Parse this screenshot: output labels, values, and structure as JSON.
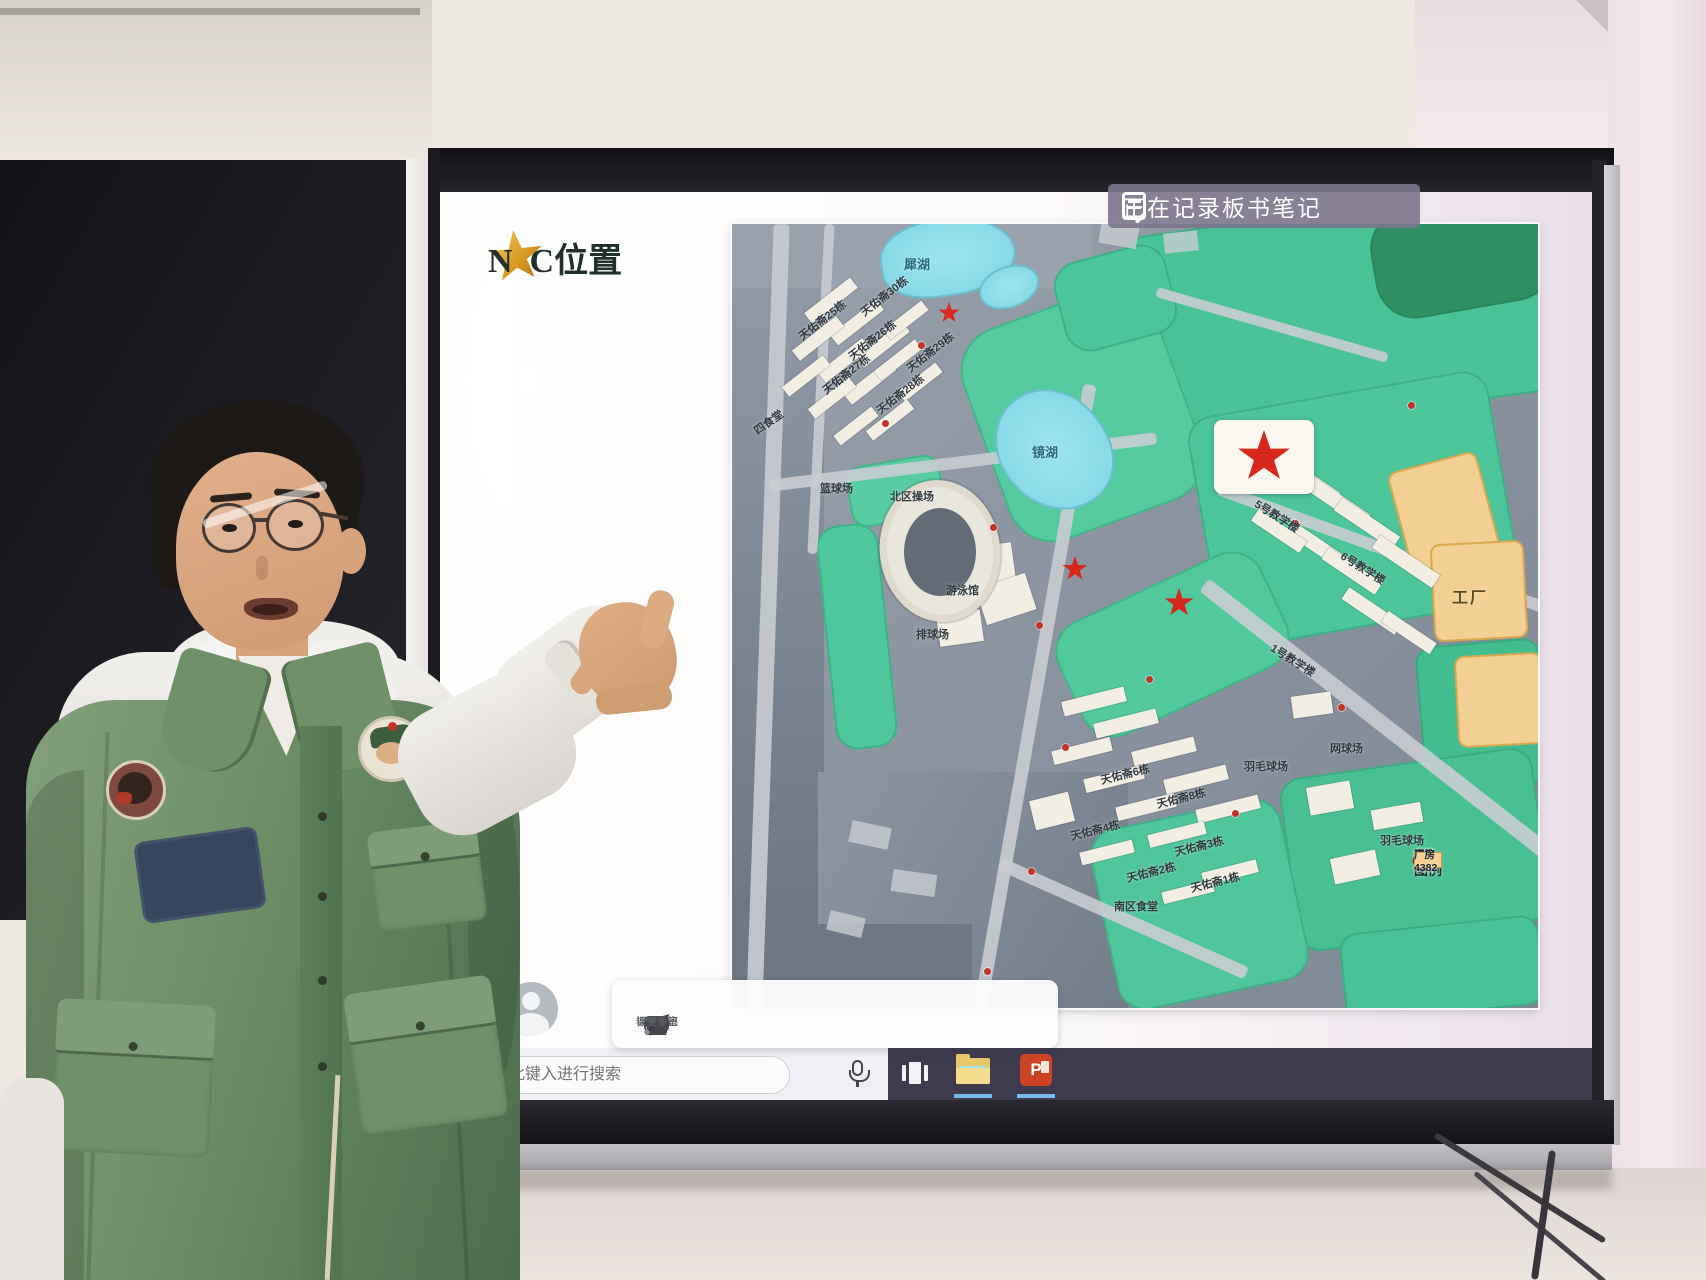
{
  "screen": {
    "recording_banner": {
      "icon": "note-pencil-icon",
      "text": "正在记录板书笔记"
    },
    "slide": {
      "title": "N  C位置"
    },
    "toolbar": {
      "avatar_icon": "person-icon",
      "items": [
        {
          "icon": "annotate-pen-icon",
          "label": "标注"
        },
        {
          "icon": "eraser-icon",
          "label": "板擦"
        },
        {
          "icon": "spotlight-icon",
          "label": "聚光"
        },
        {
          "icon": "class-activity-icon",
          "label": "课堂考察"
        },
        {
          "icon": "qa-icon",
          "label": "课堂问答",
          "badge": "QA"
        },
        {
          "icon": "notes-pencil-icon",
          "label": "板书笔记"
        },
        {
          "icon": "more-icon",
          "label": "更多"
        }
      ]
    },
    "taskbar": {
      "search_placeholder": "在此键入进行搜索",
      "powerpoint_letter": "P",
      "icons": [
        "search-icon",
        "microphone-icon",
        "task-view-icon",
        "file-explorer-icon",
        "powerpoint-icon"
      ]
    }
  },
  "map": {
    "labels": [
      {
        "t": "犀湖",
        "x": 172,
        "y": 30,
        "c": "lake-t"
      },
      {
        "t": "镜湖",
        "x": 300,
        "y": 218,
        "c": "lake-t"
      },
      {
        "t": "篮球场",
        "x": 88,
        "y": 256
      },
      {
        "t": "北区操场",
        "x": 158,
        "y": 264
      },
      {
        "t": "游泳馆",
        "x": 214,
        "y": 358
      },
      {
        "t": "排球场",
        "x": 184,
        "y": 402
      },
      {
        "t": "网球场",
        "x": 598,
        "y": 516
      },
      {
        "t": "羽毛球场",
        "x": 512,
        "y": 534
      },
      {
        "t": "羽毛球场",
        "x": 648,
        "y": 608
      },
      {
        "t": "南区食堂",
        "x": 382,
        "y": 674
      },
      {
        "t": "四食堂",
        "x": 20,
        "y": 190,
        "r": -35
      },
      {
        "t": "工厂",
        "x": 720,
        "y": 360,
        "c": "factory"
      },
      {
        "t": "5号教学楼",
        "x": 520,
        "y": 284,
        "r": 32
      },
      {
        "t": "6号教学楼",
        "x": 606,
        "y": 336,
        "r": 32
      },
      {
        "t": "1号教学楼",
        "x": 536,
        "y": 428,
        "r": 32
      },
      {
        "t": "天佑斋25栋",
        "x": 62,
        "y": 88,
        "r": -38
      },
      {
        "t": "天佑斋26栋",
        "x": 112,
        "y": 108,
        "r": -38
      },
      {
        "t": "天佑斋27栋",
        "x": 86,
        "y": 142,
        "r": -38
      },
      {
        "t": "天佑斋28栋",
        "x": 140,
        "y": 162,
        "r": -38
      },
      {
        "t": "天佑斋29栋",
        "x": 170,
        "y": 120,
        "r": -38
      },
      {
        "t": "天佑斋30栋",
        "x": 124,
        "y": 64,
        "r": -38
      },
      {
        "t": "天佑斋6栋",
        "x": 368,
        "y": 542,
        "r": -14
      },
      {
        "t": "天佑斋8栋",
        "x": 424,
        "y": 566,
        "r": -14
      },
      {
        "t": "天佑斋4栋",
        "x": 338,
        "y": 598,
        "r": -14
      },
      {
        "t": "天佑斋3栋",
        "x": 442,
        "y": 614,
        "r": -14
      },
      {
        "t": "天佑斋2栋",
        "x": 394,
        "y": 640,
        "r": -14
      },
      {
        "t": "天佑斋1栋",
        "x": 458,
        "y": 650,
        "r": -14
      }
    ],
    "stars": [
      {
        "x": 206,
        "y": 78,
        "s": 22
      },
      {
        "x": 505,
        "y": 206,
        "s": 54,
        "card": {
          "x": 482,
          "y": 196,
          "w": 100,
          "h": 74
        }
      },
      {
        "x": 330,
        "y": 332,
        "s": 26
      },
      {
        "x": 432,
        "y": 364,
        "s": 30
      }
    ],
    "legend": {
      "title": "图例",
      "items": [
        {
          "symbol": "camera-dot",
          "label": "监控4382"
        },
        {
          "symbol": "thin-line",
          "label": "小路4382"
        },
        {
          "symbol": "double-line",
          "label": "道路4382"
        },
        {
          "symbol": "building-swatch",
          "label": "建筑4382"
        },
        {
          "symbol": "factory-swatch",
          "label": "厂房4382"
        }
      ]
    }
  },
  "colors": {
    "map_green": "#4cc59a",
    "lake_cyan": "#86dbe9",
    "factory_orange": "#f2cf92",
    "star_red": "#d6281c",
    "banner_bg": "#7c758c",
    "taskbar_dark": "#3f3b4e",
    "ppt_red": "#cb4424",
    "title_gold": "#d99a23"
  }
}
